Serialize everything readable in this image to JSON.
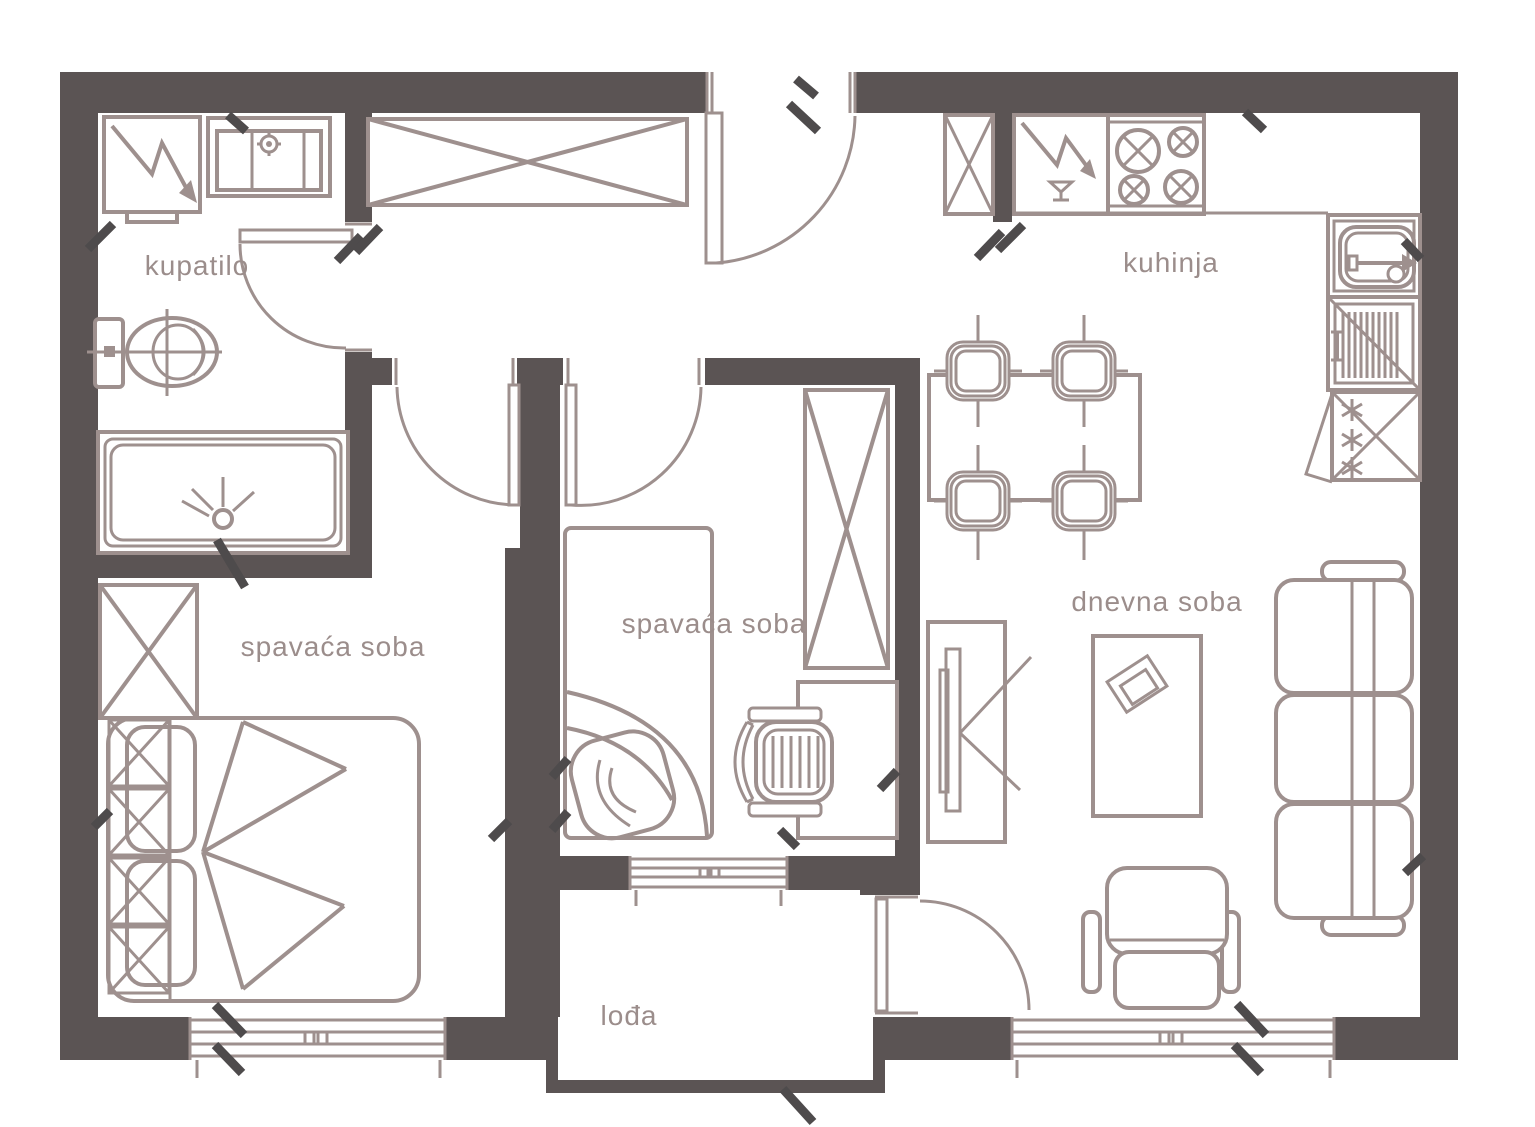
{
  "colors": {
    "background": "#ffffff",
    "wall": "#5b5454",
    "line": "#9e908e",
    "tick": "#4e4b4c",
    "label": "#9b8d8b"
  },
  "rooms": {
    "bathroom": {
      "label": "kupatilo"
    },
    "kitchen": {
      "label": "kuhinja"
    },
    "bedroom_left": {
      "label": "spavaća soba"
    },
    "bedroom_middle": {
      "label": "spavaća soba"
    },
    "living_room": {
      "label": "dnevna soba"
    },
    "loggia": {
      "label": "lođa"
    }
  },
  "furniture_icons": {
    "bathroom": [
      "washing-machine-icon",
      "sink-icon",
      "toilet-icon",
      "shower-tray-icon"
    ],
    "hallway": [
      "wardrobe-icon",
      "entrance-door-icon"
    ],
    "kitchen": [
      "cabinet-icon",
      "dishwasher-icon",
      "stove-icon",
      "kitchen-sink-icon",
      "dish-rack-icon",
      "refrigerator-icon",
      "dining-table-icon",
      "chair-icon"
    ],
    "bedroom_left": [
      "wardrobe-icon",
      "double-bed-icon",
      "window-icon"
    ],
    "bedroom_middle": [
      "single-bed-icon",
      "wardrobe-icon",
      "desk-icon",
      "office-chair-icon",
      "window-icon"
    ],
    "living_room": [
      "tv-stand-icon",
      "coffee-table-icon",
      "sofa-icon",
      "armchair-icon",
      "window-icon",
      "balcony-door-icon"
    ]
  }
}
